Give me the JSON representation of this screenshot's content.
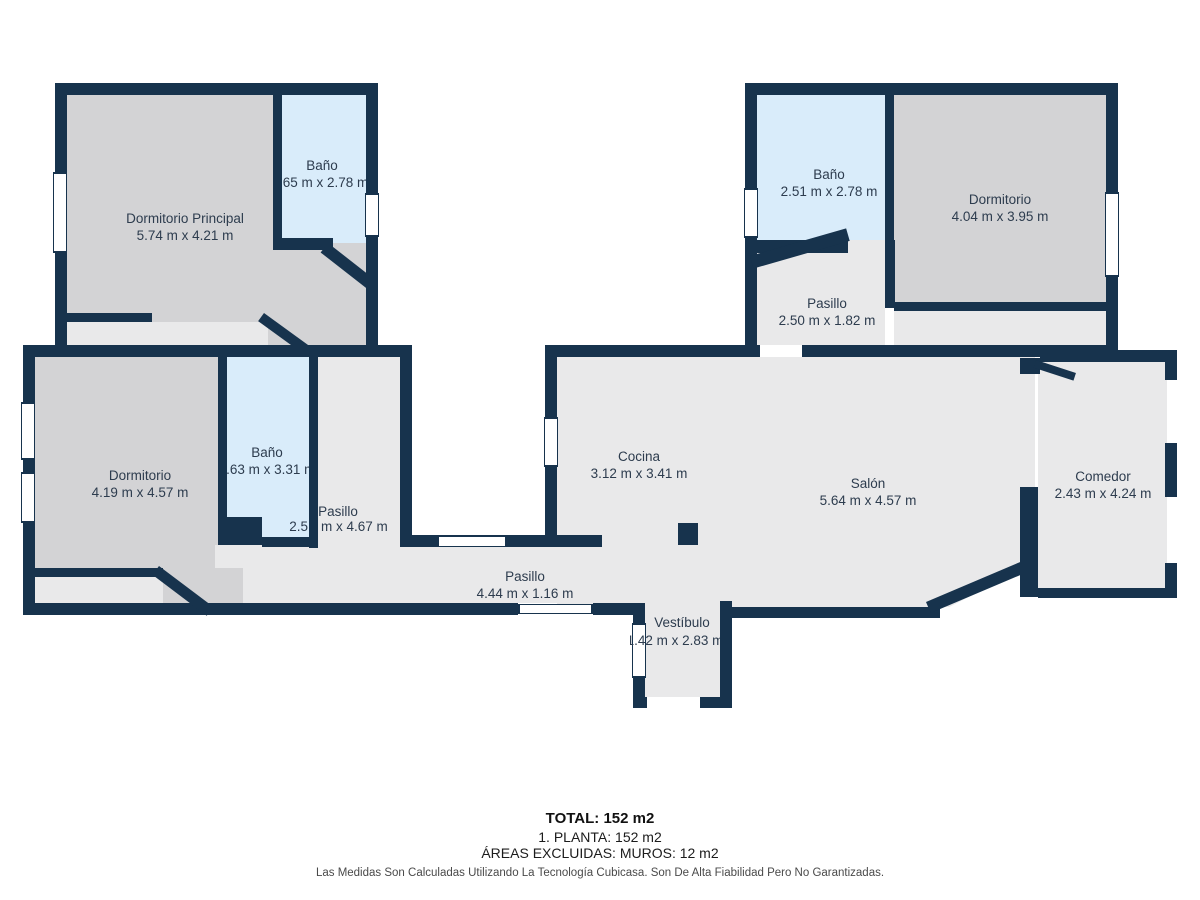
{
  "rooms": {
    "dormitorio_principal": {
      "name": "Dormitorio Principal",
      "dims": "5.74 m x 4.21 m"
    },
    "bano_top_left": {
      "name": "Baño",
      "dims": ".65 m x 2.78 m"
    },
    "bano_top_right": {
      "name": "Baño",
      "dims": "2.51 m x 2.78 m"
    },
    "dormitorio_top_right": {
      "name": "Dormitorio",
      "dims": "4.04 m x 3.95 m"
    },
    "pasillo_top_right": {
      "name": "Pasillo",
      "dims": "2.50 m x 1.82 m"
    },
    "dormitorio_left": {
      "name": "Dormitorio",
      "dims": "4.19 m x 4.57 m"
    },
    "bano_left": {
      "name": "Baño",
      "dims": "1.63 m x 3.31 m"
    },
    "pasillo_left": {
      "name": "Pasillo",
      "dims_left": "2.5",
      "dims_right": "m x 4.67 m"
    },
    "cocina": {
      "name": "Cocina",
      "dims": "3.12 m x 3.41 m"
    },
    "salon": {
      "name": "Salón",
      "dims": "5.64 m x 4.57 m"
    },
    "comedor": {
      "name": "Comedor",
      "dims": "2.43 m x 4.24 m"
    },
    "pasillo_bottom": {
      "name": "Pasillo",
      "dims": "4.44 m x 1.16 m"
    },
    "vestibulo": {
      "name": "Vestíbulo",
      "dims": "1.42 m x 2.83 m"
    }
  },
  "summary": {
    "total": "TOTAL: 152 m2",
    "floor": "1. PLANTA: 152 m2",
    "excluded": "ÁREAS EXCLUIDAS: MUROS: 12 m2"
  },
  "disclaimer": "Las Medidas Son Calculadas Utilizando La Tecnología Cubicasa. Son De Alta Fiabilidad Pero No Garantizadas.",
  "colors": {
    "wall": "#17334d",
    "bedroom_fill": "#d3d3d5",
    "room_fill": "#e9e9ea",
    "bathroom_fill": "#d9ecfa",
    "label_text": "#2d3c4e"
  }
}
